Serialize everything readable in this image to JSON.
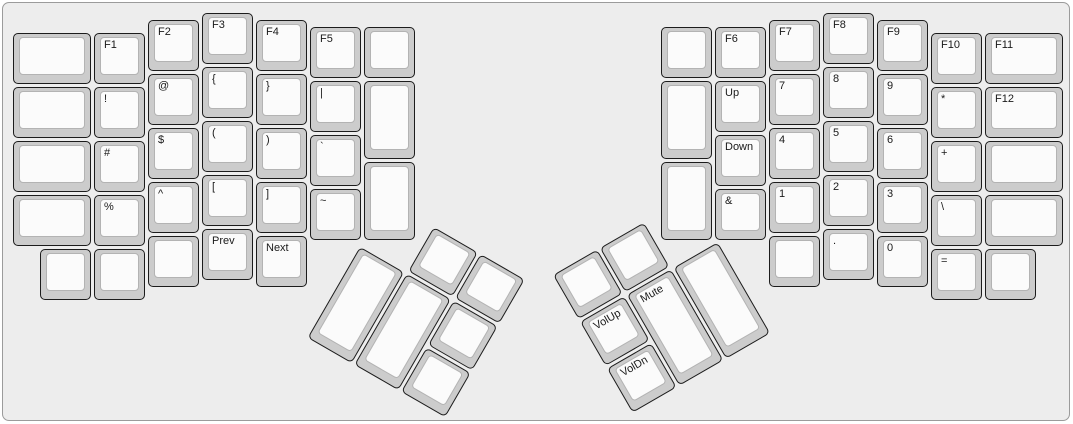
{
  "board": {
    "unit_px": 54,
    "background": "#ededed",
    "border_color": "#9b9b9b",
    "key_colors": {
      "body": "#cccccc",
      "body_border": "#1c1c1c",
      "top_surface": "#fbfbfb",
      "top_border": "#b3b3b3",
      "label": "#1a1a1a"
    }
  },
  "groups": {
    "left_main": {
      "ox": 10,
      "oy": 10,
      "rot": 0
    },
    "right_main": {
      "ox": 658,
      "oy": 10,
      "rot": 0
    },
    "left_thumb": {
      "ox": 383.7,
      "oy": 196.5,
      "rot": 30
    },
    "right_thumb": {
      "ox": 549.5,
      "oy": 271.9,
      "rot": -30
    }
  },
  "keys": [
    {
      "g": "left_main",
      "x": 0,
      "y": 0.375,
      "w": 1.5,
      "h": 1,
      "label": "",
      "name": "key-blank"
    },
    {
      "g": "left_main",
      "x": 0,
      "y": 1.375,
      "w": 1.5,
      "h": 1,
      "label": "",
      "name": "key-blank"
    },
    {
      "g": "left_main",
      "x": 0,
      "y": 2.375,
      "w": 1.5,
      "h": 1,
      "label": "",
      "name": "key-blank"
    },
    {
      "g": "left_main",
      "x": 0,
      "y": 3.375,
      "w": 1.5,
      "h": 1,
      "label": "",
      "name": "key-blank"
    },
    {
      "g": "left_main",
      "x": 1.5,
      "y": 0.375,
      "w": 1,
      "h": 1,
      "label": "F1",
      "name": "key-f1"
    },
    {
      "g": "left_main",
      "x": 1.5,
      "y": 1.375,
      "w": 1,
      "h": 1,
      "label": "!",
      "name": "key-exclamation"
    },
    {
      "g": "left_main",
      "x": 1.5,
      "y": 2.375,
      "w": 1,
      "h": 1,
      "label": "#",
      "name": "key-hash"
    },
    {
      "g": "left_main",
      "x": 1.5,
      "y": 3.375,
      "w": 1,
      "h": 1,
      "label": "%",
      "name": "key-percent"
    },
    {
      "g": "left_main",
      "x": 2.5,
      "y": 0.125,
      "w": 1,
      "h": 1,
      "label": "F2",
      "name": "key-f2"
    },
    {
      "g": "left_main",
      "x": 2.5,
      "y": 1.125,
      "w": 1,
      "h": 1,
      "label": "@",
      "name": "key-at"
    },
    {
      "g": "left_main",
      "x": 2.5,
      "y": 2.125,
      "w": 1,
      "h": 1,
      "label": "$",
      "name": "key-dollar"
    },
    {
      "g": "left_main",
      "x": 2.5,
      "y": 3.125,
      "w": 1,
      "h": 1,
      "label": "^",
      "name": "key-caret"
    },
    {
      "g": "left_main",
      "x": 3.5,
      "y": 0,
      "w": 1,
      "h": 1,
      "label": "F3",
      "name": "key-f3"
    },
    {
      "g": "left_main",
      "x": 3.5,
      "y": 1,
      "w": 1,
      "h": 1,
      "label": "{",
      "name": "key-brace-open"
    },
    {
      "g": "left_main",
      "x": 3.5,
      "y": 2,
      "w": 1,
      "h": 1,
      "label": "(",
      "name": "key-paren-open"
    },
    {
      "g": "left_main",
      "x": 3.5,
      "y": 3,
      "w": 1,
      "h": 1,
      "label": "[",
      "name": "key-bracket-open"
    },
    {
      "g": "left_main",
      "x": 4.5,
      "y": 0.125,
      "w": 1,
      "h": 1,
      "label": "F4",
      "name": "key-f4"
    },
    {
      "g": "left_main",
      "x": 4.5,
      "y": 1.125,
      "w": 1,
      "h": 1,
      "label": "}",
      "name": "key-brace-close"
    },
    {
      "g": "left_main",
      "x": 4.5,
      "y": 2.125,
      "w": 1,
      "h": 1,
      "label": ")",
      "name": "key-paren-close"
    },
    {
      "g": "left_main",
      "x": 4.5,
      "y": 3.125,
      "w": 1,
      "h": 1,
      "label": "]",
      "name": "key-bracket-close"
    },
    {
      "g": "left_main",
      "x": 5.5,
      "y": 0.25,
      "w": 1,
      "h": 1,
      "label": "F5",
      "name": "key-f5"
    },
    {
      "g": "left_main",
      "x": 5.5,
      "y": 1.25,
      "w": 1,
      "h": 1,
      "label": "|",
      "name": "key-pipe"
    },
    {
      "g": "left_main",
      "x": 5.5,
      "y": 2.25,
      "w": 1,
      "h": 1,
      "label": "`",
      "name": "key-backtick"
    },
    {
      "g": "left_main",
      "x": 5.5,
      "y": 3.25,
      "w": 1,
      "h": 1,
      "label": "~",
      "name": "key-tilde"
    },
    {
      "g": "left_main",
      "x": 6.5,
      "y": 0.25,
      "w": 1,
      "h": 1,
      "label": "",
      "name": "key-blank"
    },
    {
      "g": "left_main",
      "x": 6.5,
      "y": 1.25,
      "w": 1,
      "h": 1.5,
      "label": "",
      "name": "key-blank"
    },
    {
      "g": "left_main",
      "x": 6.5,
      "y": 2.75,
      "w": 1,
      "h": 1.5,
      "label": "",
      "name": "key-blank"
    },
    {
      "g": "left_main",
      "x": 0.5,
      "y": 4.375,
      "w": 1,
      "h": 1,
      "label": "",
      "name": "key-blank"
    },
    {
      "g": "left_main",
      "x": 1.5,
      "y": 4.375,
      "w": 1,
      "h": 1,
      "label": "",
      "name": "key-blank"
    },
    {
      "g": "left_main",
      "x": 2.5,
      "y": 4.125,
      "w": 1,
      "h": 1,
      "label": "",
      "name": "key-blank"
    },
    {
      "g": "left_main",
      "x": 3.5,
      "y": 4,
      "w": 1,
      "h": 1,
      "label": "Prev",
      "name": "key-prev"
    },
    {
      "g": "left_main",
      "x": 4.5,
      "y": 4.125,
      "w": 1,
      "h": 1,
      "label": "Next",
      "name": "key-next"
    },
    {
      "g": "right_main",
      "x": 0,
      "y": 0.25,
      "w": 1,
      "h": 1,
      "label": "",
      "name": "key-blank"
    },
    {
      "g": "right_main",
      "x": 0,
      "y": 1.25,
      "w": 1,
      "h": 1.5,
      "label": "",
      "name": "key-blank"
    },
    {
      "g": "right_main",
      "x": 0,
      "y": 2.75,
      "w": 1,
      "h": 1.5,
      "label": "",
      "name": "key-blank"
    },
    {
      "g": "right_main",
      "x": 1,
      "y": 0.25,
      "w": 1,
      "h": 1,
      "label": "F6",
      "name": "key-f6"
    },
    {
      "g": "right_main",
      "x": 1,
      "y": 1.25,
      "w": 1,
      "h": 1,
      "label": "Up",
      "name": "key-up"
    },
    {
      "g": "right_main",
      "x": 1,
      "y": 2.25,
      "w": 1,
      "h": 1,
      "label": "Down",
      "name": "key-down"
    },
    {
      "g": "right_main",
      "x": 1,
      "y": 3.25,
      "w": 1,
      "h": 1,
      "label": "&",
      "name": "key-ampersand"
    },
    {
      "g": "right_main",
      "x": 2,
      "y": 0.125,
      "w": 1,
      "h": 1,
      "label": "F7",
      "name": "key-f7"
    },
    {
      "g": "right_main",
      "x": 2,
      "y": 1.125,
      "w": 1,
      "h": 1,
      "label": "7",
      "name": "key-7"
    },
    {
      "g": "right_main",
      "x": 2,
      "y": 2.125,
      "w": 1,
      "h": 1,
      "label": "4",
      "name": "key-4"
    },
    {
      "g": "right_main",
      "x": 2,
      "y": 3.125,
      "w": 1,
      "h": 1,
      "label": "1",
      "name": "key-1"
    },
    {
      "g": "right_main",
      "x": 3,
      "y": 0,
      "w": 1,
      "h": 1,
      "label": "F8",
      "name": "key-f8"
    },
    {
      "g": "right_main",
      "x": 3,
      "y": 1,
      "w": 1,
      "h": 1,
      "label": "8",
      "name": "key-8"
    },
    {
      "g": "right_main",
      "x": 3,
      "y": 2,
      "w": 1,
      "h": 1,
      "label": "5",
      "name": "key-5"
    },
    {
      "g": "right_main",
      "x": 3,
      "y": 3,
      "w": 1,
      "h": 1,
      "label": "2",
      "name": "key-2"
    },
    {
      "g": "right_main",
      "x": 4,
      "y": 0.125,
      "w": 1,
      "h": 1,
      "label": "F9",
      "name": "key-f9"
    },
    {
      "g": "right_main",
      "x": 4,
      "y": 1.125,
      "w": 1,
      "h": 1,
      "label": "9",
      "name": "key-9"
    },
    {
      "g": "right_main",
      "x": 4,
      "y": 2.125,
      "w": 1,
      "h": 1,
      "label": "6",
      "name": "key-6"
    },
    {
      "g": "right_main",
      "x": 4,
      "y": 3.125,
      "w": 1,
      "h": 1,
      "label": "3",
      "name": "key-3"
    },
    {
      "g": "right_main",
      "x": 5,
      "y": 0.375,
      "w": 1,
      "h": 1,
      "label": "F10",
      "name": "key-f10"
    },
    {
      "g": "right_main",
      "x": 5,
      "y": 1.375,
      "w": 1,
      "h": 1,
      "label": "*",
      "name": "key-asterisk"
    },
    {
      "g": "right_main",
      "x": 5,
      "y": 2.375,
      "w": 1,
      "h": 1,
      "label": "+",
      "name": "key-plus"
    },
    {
      "g": "right_main",
      "x": 5,
      "y": 3.375,
      "w": 1,
      "h": 1,
      "label": "\\",
      "name": "key-backslash"
    },
    {
      "g": "right_main",
      "x": 6,
      "y": 0.375,
      "w": 1.5,
      "h": 1,
      "label": "F11",
      "name": "key-f11"
    },
    {
      "g": "right_main",
      "x": 6,
      "y": 1.375,
      "w": 1.5,
      "h": 1,
      "label": "F12",
      "name": "key-f12"
    },
    {
      "g": "right_main",
      "x": 6,
      "y": 2.375,
      "w": 1.5,
      "h": 1,
      "label": "",
      "name": "key-blank"
    },
    {
      "g": "right_main",
      "x": 6,
      "y": 3.375,
      "w": 1.5,
      "h": 1,
      "label": "",
      "name": "key-blank"
    },
    {
      "g": "right_main",
      "x": 2,
      "y": 4.125,
      "w": 1,
      "h": 1,
      "label": "",
      "name": "key-blank"
    },
    {
      "g": "right_main",
      "x": 3,
      "y": 4,
      "w": 1,
      "h": 1,
      "label": ".",
      "name": "key-period"
    },
    {
      "g": "right_main",
      "x": 4,
      "y": 4.125,
      "w": 1,
      "h": 1,
      "label": "0",
      "name": "key-0"
    },
    {
      "g": "right_main",
      "x": 5,
      "y": 4.375,
      "w": 1,
      "h": 1,
      "label": "=",
      "name": "key-equals"
    },
    {
      "g": "right_main",
      "x": 6,
      "y": 4.375,
      "w": 1,
      "h": 1,
      "label": "",
      "name": "key-blank"
    },
    {
      "g": "left_thumb",
      "x": 1,
      "y": 0,
      "w": 1,
      "h": 1,
      "label": "",
      "name": "key-blank"
    },
    {
      "g": "left_thumb",
      "x": 2,
      "y": 0,
      "w": 1,
      "h": 1,
      "label": "",
      "name": "key-blank"
    },
    {
      "g": "left_thumb",
      "x": 0,
      "y": 1,
      "w": 1,
      "h": 2,
      "label": "",
      "name": "key-blank"
    },
    {
      "g": "left_thumb",
      "x": 1,
      "y": 1,
      "w": 1,
      "h": 2,
      "label": "",
      "name": "key-blank"
    },
    {
      "g": "left_thumb",
      "x": 2,
      "y": 1,
      "w": 1,
      "h": 1,
      "label": "",
      "name": "key-blank"
    },
    {
      "g": "left_thumb",
      "x": 2,
      "y": 2,
      "w": 1,
      "h": 1,
      "label": "",
      "name": "key-blank"
    },
    {
      "g": "right_thumb",
      "x": 0,
      "y": 0,
      "w": 1,
      "h": 1,
      "label": "",
      "name": "key-blank"
    },
    {
      "g": "right_thumb",
      "x": 1,
      "y": 0,
      "w": 1,
      "h": 1,
      "label": "",
      "name": "key-blank"
    },
    {
      "g": "right_thumb",
      "x": 0,
      "y": 1,
      "w": 1,
      "h": 1,
      "label": "VolUp",
      "name": "key-volume-up"
    },
    {
      "g": "right_thumb",
      "x": 0,
      "y": 2,
      "w": 1,
      "h": 1,
      "label": "VolDn",
      "name": "key-volume-down"
    },
    {
      "g": "right_thumb",
      "x": 1,
      "y": 1,
      "w": 1,
      "h": 2,
      "label": "Mute",
      "name": "key-mute"
    },
    {
      "g": "right_thumb",
      "x": 2,
      "y": 1,
      "w": 1,
      "h": 2,
      "label": "",
      "name": "key-blank"
    }
  ]
}
